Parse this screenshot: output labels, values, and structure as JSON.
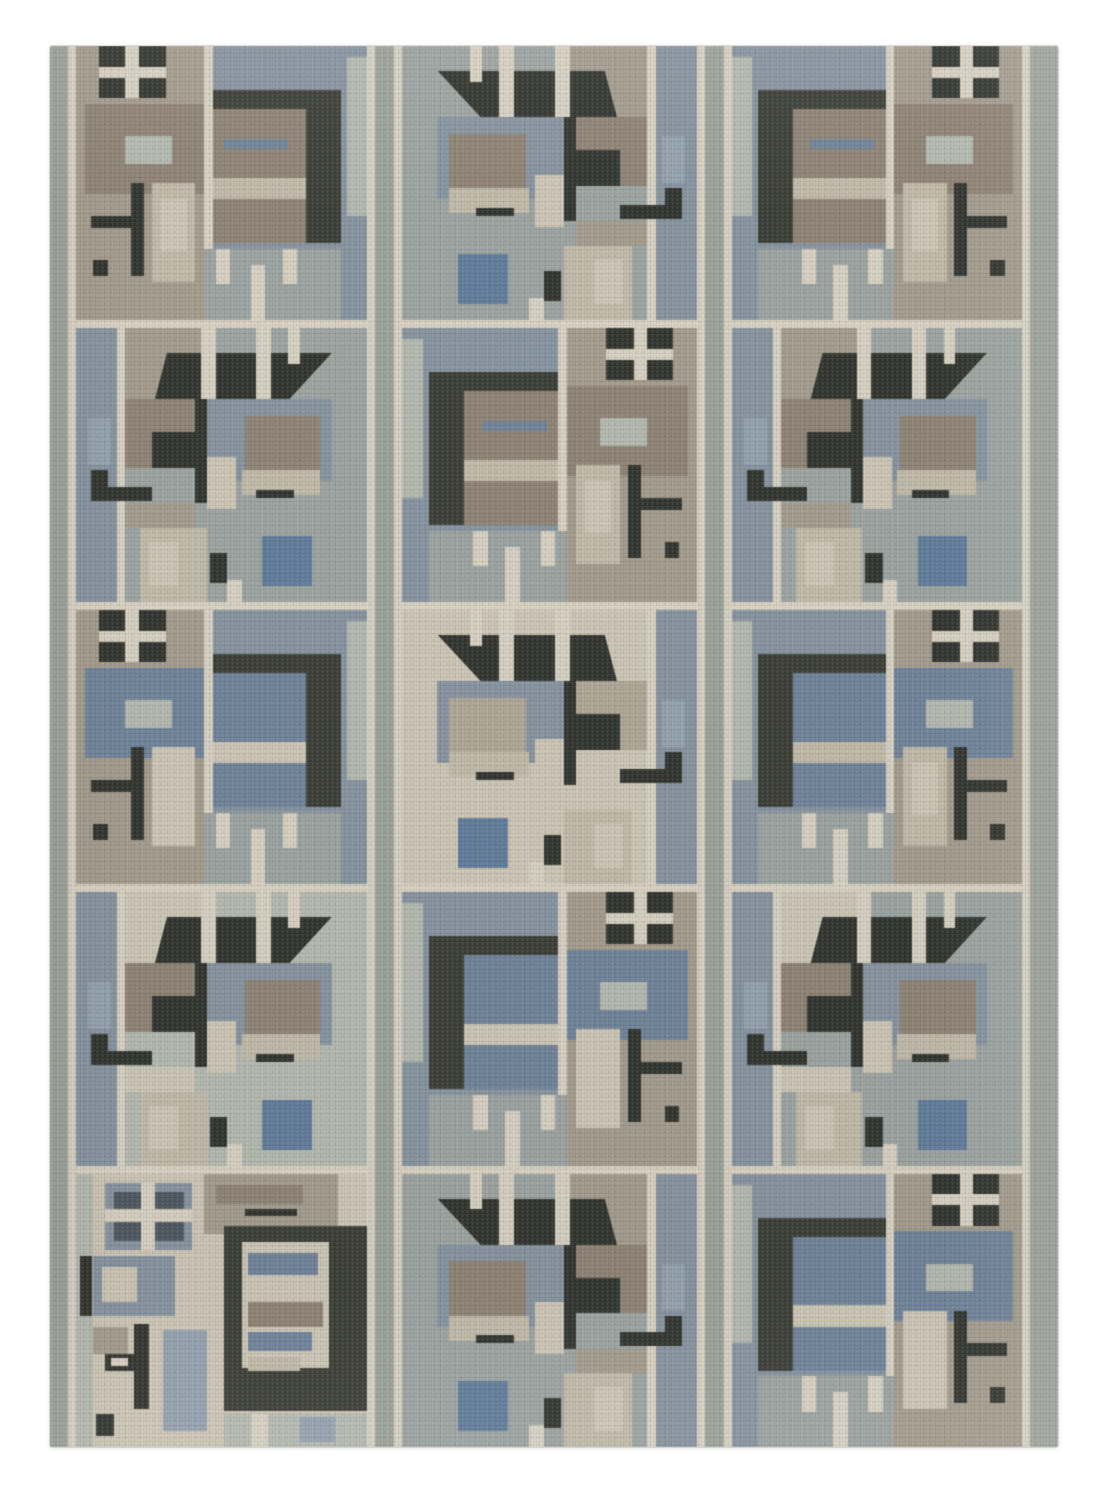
{
  "description": "Photograph of a Scandinavian-style geometric flatweave wool rug on a plain white background. The rug has three vertical pattern columns divided by gray-green striped bands and five rows of abstract modernist motif tiles: four-pane window crosses, dark charcoal canopy and bracket shapes, striped taupe and slate-blue blocks, steel-blue accent squares and cream grid lines.",
  "canvas": {
    "width": 1112,
    "height": 1500,
    "background": "#ffffff"
  },
  "rug": {
    "left": 50,
    "top": 46,
    "width": 1008,
    "height": 1401,
    "base": "cream"
  },
  "palette": {
    "cream": "#d9d2c2",
    "light": "#cec7b6",
    "beige": "#c2bba9",
    "tan": "#b0a795",
    "taupe": "#8e8272",
    "warmgray": "#a49b8c",
    "graygreen": "#9ba39a",
    "sagelight": "#b5bab0",
    "field": "#9ba4a1",
    "slate": "#8593a0",
    "bluegray": "#93a2b0",
    "steelblue": "#5e7b9d",
    "mutedblue": "#6d829b",
    "charcoal": "#383b33",
    "dark": "#2e312a",
    "darkslate": "#4b555e"
  },
  "layout": {
    "vbands": [
      {
        "x": 0,
        "w": 18,
        "c": "graygreen"
      },
      {
        "x": 18,
        "w": 8,
        "c": "cream"
      },
      {
        "x": 317,
        "w": 8,
        "c": "cream"
      },
      {
        "x": 325,
        "w": 19,
        "c": "graygreen"
      },
      {
        "x": 344,
        "w": 8,
        "c": "cream"
      },
      {
        "x": 647,
        "w": 8,
        "c": "cream"
      },
      {
        "x": 655,
        "w": 19,
        "c": "graygreen"
      },
      {
        "x": 674,
        "w": 8,
        "c": "cream"
      },
      {
        "x": 972,
        "w": 8,
        "c": "cream"
      },
      {
        "x": 980,
        "w": 28,
        "c": "graygreen"
      }
    ],
    "columns": [
      {
        "x": 26,
        "w": 291
      },
      {
        "x": 352,
        "w": 295
      },
      {
        "x": 682,
        "w": 290
      }
    ],
    "rows": [
      {
        "y": 0,
        "h": 274
      },
      {
        "y": 282,
        "h": 274
      },
      {
        "y": 564,
        "h": 274
      },
      {
        "y": 846,
        "h": 274
      },
      {
        "y": 1128,
        "h": 273
      }
    ]
  },
  "motifs": {
    "A": {
      "base": "warmgray",
      "shapes": [
        {
          "x": 44,
          "y": 0,
          "w": 56,
          "h": 100,
          "c": "slate"
        },
        {
          "x": 93,
          "y": 4,
          "w": 7,
          "h": 58,
          "c": "sagelight"
        },
        {
          "x": 8,
          "y": 0,
          "w": 23,
          "h": 19,
          "c": "dark"
        },
        {
          "x": 17,
          "y": 0,
          "w": 4.5,
          "h": 19,
          "c": "cream"
        },
        {
          "x": 8,
          "y": 7.5,
          "w": 23,
          "h": 4,
          "c": "cream"
        },
        {
          "x": 3,
          "y": 21,
          "w": 41,
          "h": 33,
          "c": "taupe",
          "tex": 1
        },
        {
          "x": 17,
          "y": 33,
          "w": 16,
          "h": 10,
          "c": "sagelight"
        },
        {
          "x": 44,
          "y": 0,
          "w": 3,
          "h": 74,
          "c": "cream"
        },
        {
          "x": 47,
          "y": 16,
          "w": 44,
          "h": 7,
          "c": "charcoal"
        },
        {
          "x": 79,
          "y": 16,
          "w": 12,
          "h": 56,
          "c": "charcoal"
        },
        {
          "x": 47,
          "y": 23,
          "w": 32,
          "h": 25,
          "c": "taupe",
          "tex": 1
        },
        {
          "x": 51,
          "y": 34,
          "w": 22,
          "h": 3.5,
          "c": "mutedblue"
        },
        {
          "x": 47,
          "y": 48,
          "w": 32,
          "h": 8,
          "c": "beige"
        },
        {
          "x": 47,
          "y": 56,
          "w": 32,
          "h": 16,
          "c": "taupe",
          "tex": 1
        },
        {
          "x": 19,
          "y": 50,
          "w": 4.5,
          "h": 34,
          "c": "dark"
        },
        {
          "x": 5,
          "y": 62,
          "w": 18,
          "h": 4.5,
          "c": "dark"
        },
        {
          "x": 6,
          "y": 78,
          "w": 5,
          "h": 6,
          "c": "dark"
        },
        {
          "x": 26,
          "y": 50,
          "w": 15,
          "h": 36,
          "c": "beige"
        },
        {
          "x": 29,
          "y": 56,
          "w": 9,
          "h": 19,
          "c": "light"
        },
        {
          "x": 44,
          "y": 74,
          "w": 47,
          "h": 26,
          "c": "field"
        },
        {
          "x": 48,
          "y": 74,
          "w": 5,
          "h": 13,
          "c": "cream"
        },
        {
          "x": 60,
          "y": 80,
          "w": 5,
          "h": 20,
          "c": "cream"
        },
        {
          "x": 71,
          "y": 74,
          "w": 5,
          "h": 13,
          "c": "cream"
        }
      ]
    },
    "B": {
      "base": "field",
      "shapes": [
        {
          "x": 0,
          "y": 0,
          "w": 14,
          "h": 100,
          "c": "slate"
        },
        {
          "x": 14,
          "y": 0,
          "w": 3,
          "h": 100,
          "c": "cream"
        },
        {
          "x": 17,
          "y": 0,
          "w": 28,
          "h": 26,
          "c": "warmgray"
        },
        {
          "x": 88,
          "y": 0,
          "w": 12,
          "h": 100,
          "c": "field"
        },
        {
          "x": 18,
          "y": 9,
          "w": 70,
          "h": 17,
          "c": "dark",
          "clip": "polygon(13% 100%, 19% 0%, 100% 0%, 79% 100%)"
        },
        {
          "x": 43,
          "y": 0,
          "w": 5,
          "h": 26,
          "c": "cream"
        },
        {
          "x": 62,
          "y": 0,
          "w": 5,
          "h": 26,
          "c": "cream"
        },
        {
          "x": 73,
          "y": 0,
          "w": 4,
          "h": 13,
          "c": "cream"
        },
        {
          "x": 41,
          "y": 26,
          "w": 4.5,
          "h": 38,
          "c": "dark"
        },
        {
          "x": 17,
          "y": 26,
          "w": 24,
          "h": 25,
          "c": "taupe",
          "tex": 1
        },
        {
          "x": 26,
          "y": 38,
          "w": 15,
          "h": 13,
          "c": "dark"
        },
        {
          "x": 4,
          "y": 33,
          "w": 8,
          "h": 17,
          "c": "bluegray"
        },
        {
          "x": 5,
          "y": 52,
          "w": 6,
          "h": 11,
          "c": "dark"
        },
        {
          "x": 5,
          "y": 58,
          "w": 21,
          "h": 5,
          "c": "dark"
        },
        {
          "x": 45,
          "y": 26,
          "w": 43,
          "h": 30,
          "c": "slate"
        },
        {
          "x": 58,
          "y": 32,
          "w": 26,
          "h": 22,
          "c": "taupe",
          "tex": 1
        },
        {
          "x": 45,
          "y": 47,
          "w": 10,
          "h": 19,
          "c": "light"
        },
        {
          "x": 57,
          "y": 52,
          "w": 27,
          "h": 9,
          "c": "beige"
        },
        {
          "x": 62,
          "y": 59,
          "w": 13,
          "h": 3,
          "c": "dark"
        },
        {
          "x": 17,
          "y": 64,
          "w": 24,
          "h": 9,
          "c": "warmgray"
        },
        {
          "x": 22,
          "y": 73,
          "w": 23,
          "h": 27,
          "c": "beige"
        },
        {
          "x": 25,
          "y": 78,
          "w": 10,
          "h": 16,
          "c": "light"
        },
        {
          "x": 64,
          "y": 76,
          "w": 17,
          "h": 18,
          "c": "steelblue",
          "tex": 1
        },
        {
          "x": 46,
          "y": 82,
          "w": 6,
          "h": 11,
          "c": "dark"
        },
        {
          "x": 52,
          "y": 92,
          "w": 5,
          "h": 8,
          "c": "cream"
        }
      ]
    },
    "C": {
      "base": "light",
      "shapes": [
        {
          "x": 0,
          "y": 0,
          "w": 6,
          "h": 100,
          "c": "sagelight"
        },
        {
          "x": 44,
          "y": 0,
          "w": 46,
          "h": 22,
          "c": "warmgray"
        },
        {
          "x": 48,
          "y": 4,
          "w": 30,
          "h": 7,
          "c": "taupe",
          "tex": 1
        },
        {
          "x": 58,
          "y": 13,
          "w": 18,
          "h": 2.5,
          "c": "dark"
        },
        {
          "x": 9.8,
          "y": 3.4,
          "w": 30,
          "h": 24.3,
          "c": "slate"
        },
        {
          "x": 13,
          "y": 6.5,
          "w": 24,
          "h": 18,
          "c": "darkslate"
        },
        {
          "x": 22.5,
          "y": 3.4,
          "w": 4.5,
          "h": 24.3,
          "c": "cream"
        },
        {
          "x": 9.8,
          "y": 13,
          "w": 30,
          "h": 4.5,
          "c": "cream"
        },
        {
          "x": 51,
          "y": 19,
          "w": 49,
          "h": 68,
          "c": "charcoal"
        },
        {
          "x": 57,
          "y": 25,
          "w": 30,
          "h": 46,
          "c": "light"
        },
        {
          "x": 59,
          "y": 29,
          "w": 24,
          "h": 8,
          "c": "mutedblue",
          "tex": 1
        },
        {
          "x": 59,
          "y": 47,
          "w": 26,
          "h": 9,
          "c": "taupe",
          "tex": 1
        },
        {
          "x": 59,
          "y": 58,
          "w": 22,
          "h": 7,
          "c": "mutedblue",
          "tex": 1
        },
        {
          "x": 59,
          "y": 67,
          "w": 18,
          "h": 5,
          "c": "beige"
        },
        {
          "x": 1.5,
          "y": 30,
          "w": 4,
          "h": 22,
          "c": "dark"
        },
        {
          "x": 6,
          "y": 30,
          "w": 28,
          "h": 22,
          "c": "slate"
        },
        {
          "x": 9,
          "y": 34,
          "w": 12,
          "h": 13,
          "c": "light"
        },
        {
          "x": 6,
          "y": 56,
          "w": 12,
          "h": 10,
          "c": "warmgray"
        },
        {
          "x": 20,
          "y": 55,
          "w": 5,
          "h": 31,
          "c": "dark"
        },
        {
          "x": 10,
          "y": 66,
          "w": 10,
          "h": 6,
          "c": "dark"
        },
        {
          "x": 12,
          "y": 67.5,
          "w": 6,
          "h": 3,
          "c": "cream"
        },
        {
          "x": 30,
          "y": 57,
          "w": 15,
          "h": 37,
          "c": "bluegray",
          "tex": 1
        },
        {
          "x": 7,
          "y": 88,
          "w": 6,
          "h": 8,
          "c": "dark"
        },
        {
          "x": 51,
          "y": 88,
          "w": 49,
          "h": 12,
          "c": "sagelight"
        },
        {
          "x": 60,
          "y": 88,
          "w": 6,
          "h": 12,
          "c": "cream"
        },
        {
          "x": 77,
          "y": 89,
          "w": 12,
          "h": 9,
          "c": "bluegray"
        }
      ]
    }
  },
  "grid": [
    [
      {
        "m": "A"
      },
      {
        "m": "B"
      },
      {
        "m": "A",
        "map": {
          "taupe": "mutedblue",
          "beige": "light"
        }
      },
      {
        "m": "B",
        "map": {
          "warmgray": "light",
          "field": "sagelight"
        }
      },
      {
        "m": "C"
      }
    ],
    [
      {
        "m": "B",
        "flip": true
      },
      {
        "m": "A",
        "flip": true
      },
      {
        "m": "B",
        "flip": true,
        "map": {
          "warmgray": "light",
          "taupe": "tan",
          "field": "light"
        }
      },
      {
        "m": "A",
        "flip": true,
        "map": {
          "taupe": "mutedblue",
          "beige": "light"
        }
      },
      {
        "m": "B",
        "flip": true
      }
    ],
    [
      {
        "m": "A",
        "flip": true
      },
      {
        "m": "B"
      },
      {
        "m": "A",
        "flip": true,
        "map": {
          "taupe": "mutedblue"
        }
      },
      {
        "m": "B",
        "map": {
          "warmgray": "light"
        }
      },
      {
        "m": "A",
        "flip": true,
        "map": {
          "taupe": "mutedblue",
          "beige": "light"
        }
      }
    ]
  ]
}
